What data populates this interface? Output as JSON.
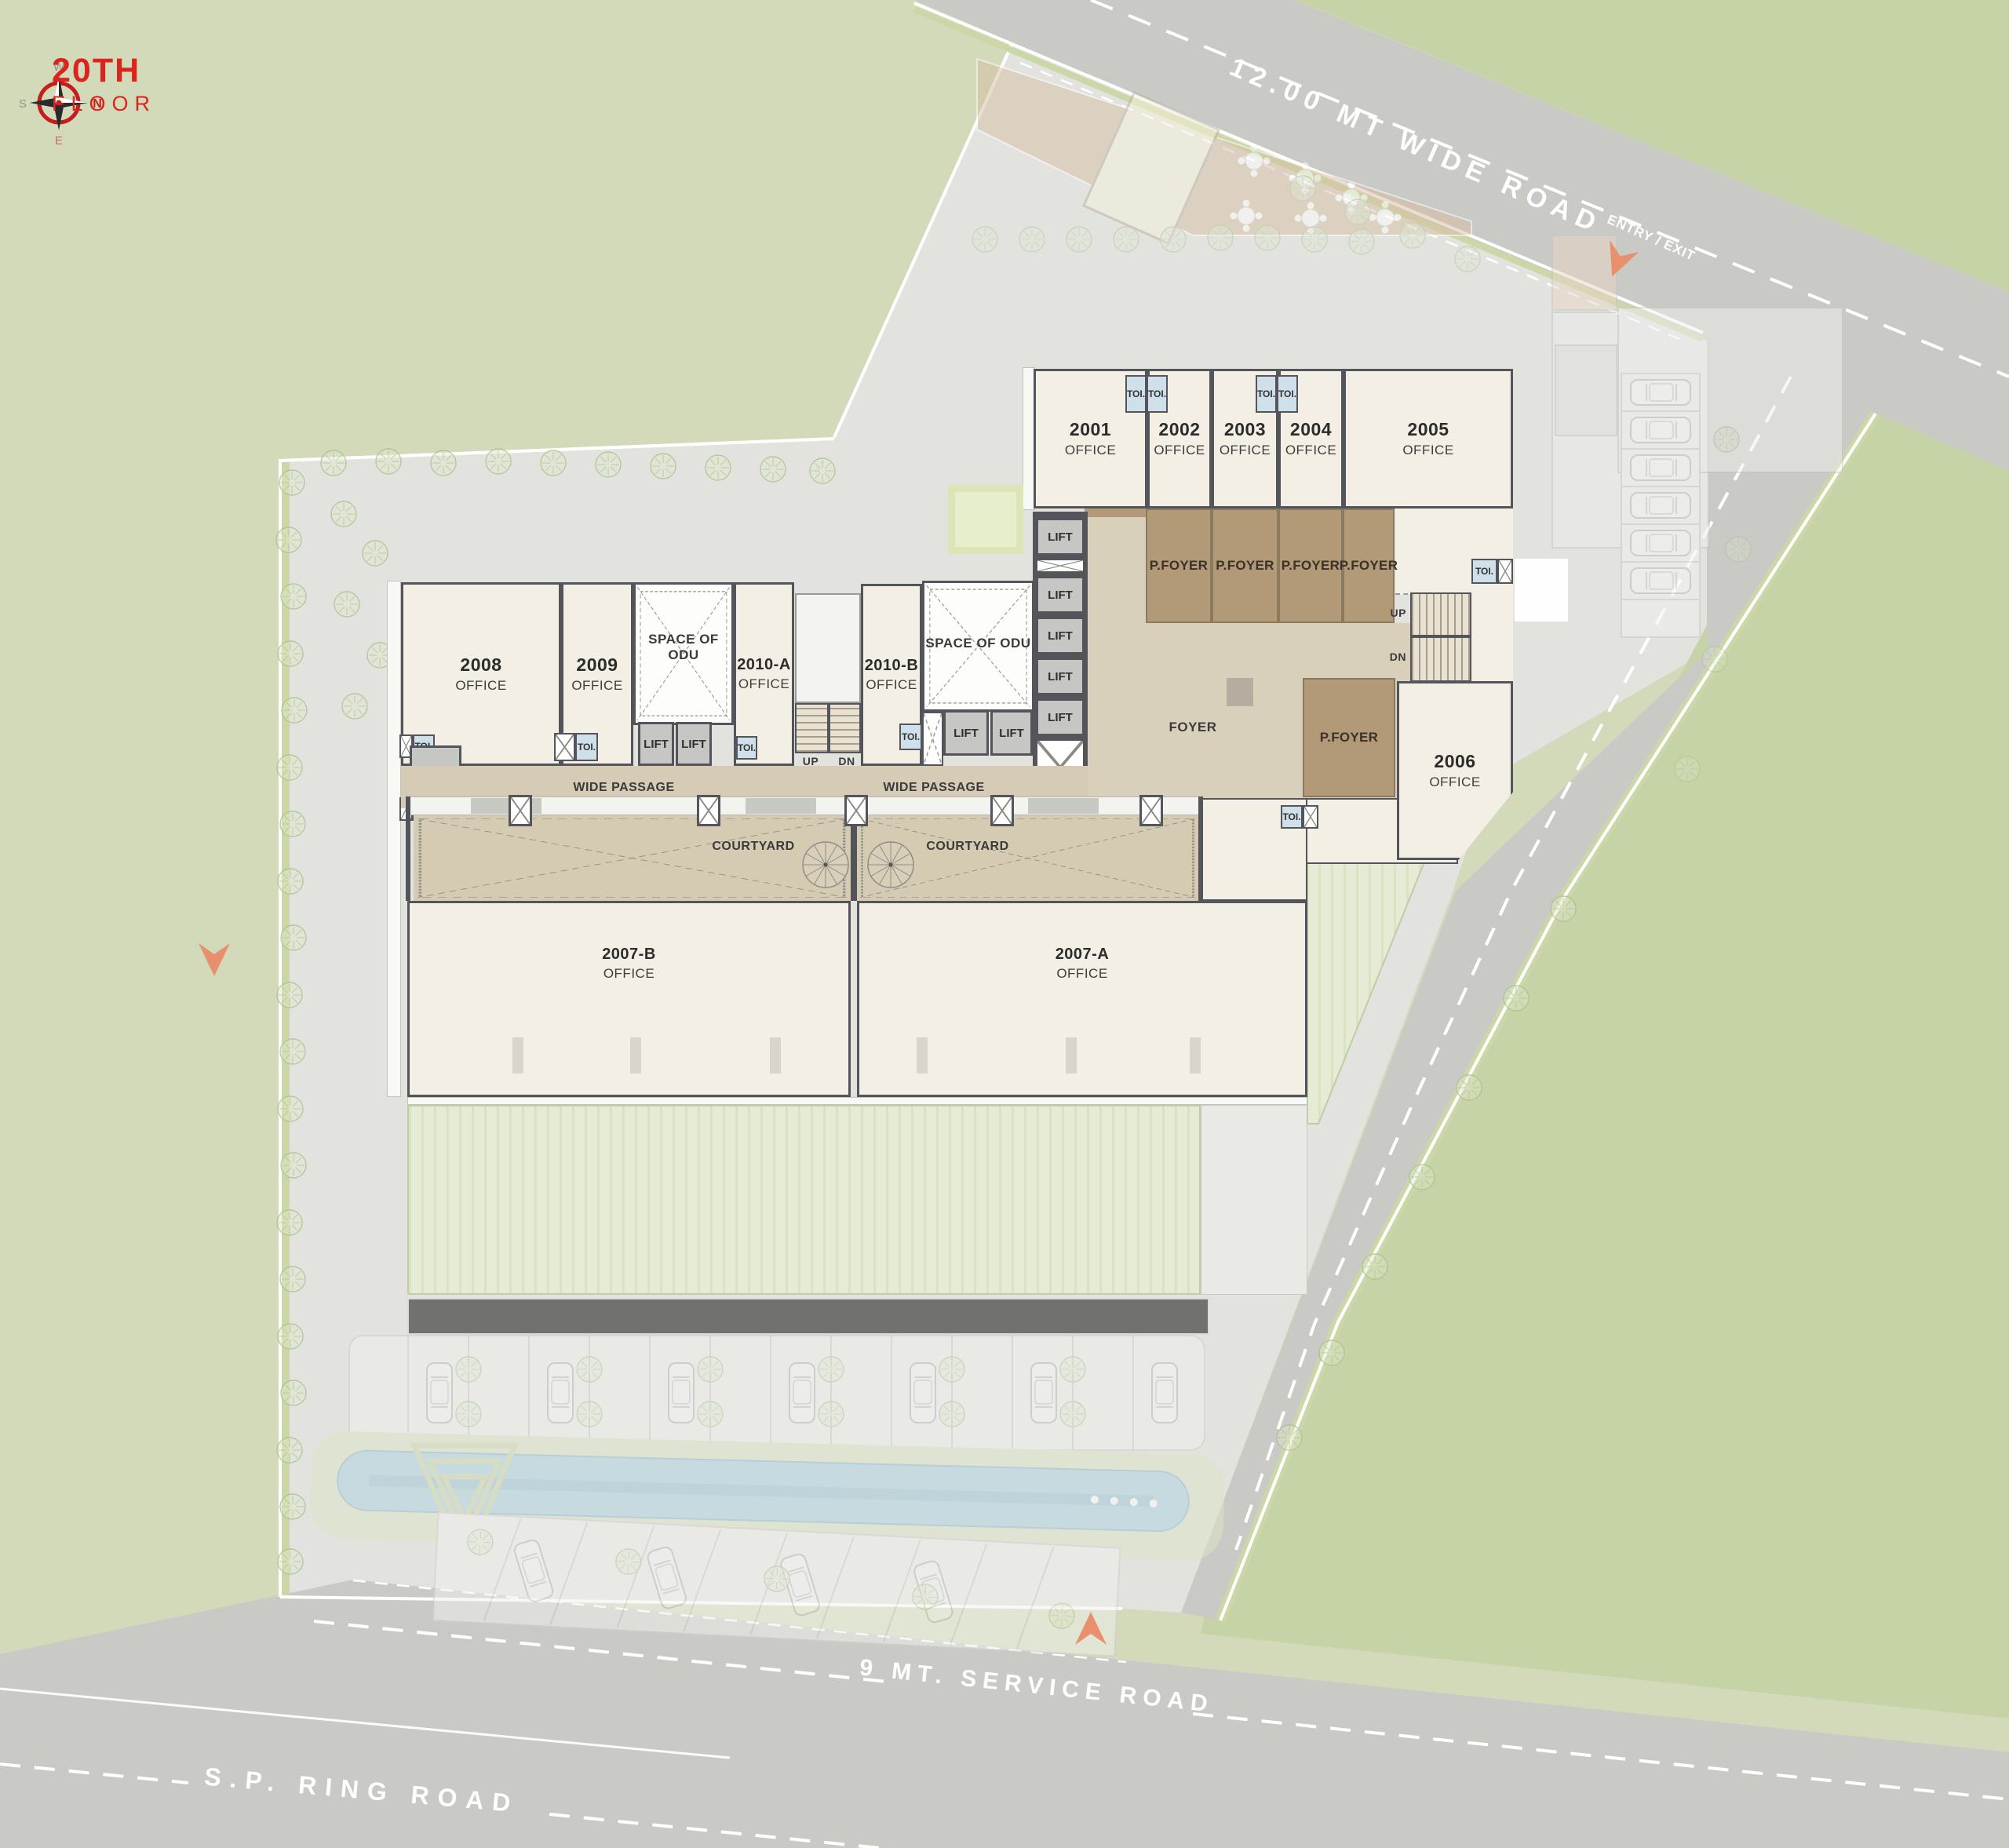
{
  "title": {
    "floor": "20TH",
    "level": "FLOOR"
  },
  "compass": {
    "n": "N",
    "e": "E",
    "s": "S",
    "w": "W"
  },
  "roads": {
    "wide_road": "12.00 MT WIDE ROAD",
    "service_road": "9 MT. SERVICE ROAD",
    "ring_road": "S.P. RING ROAD",
    "entry_exit": "ENTRY / EXIT"
  },
  "plan": {
    "lift": "LIFT",
    "toilet": "TOI.",
    "foyer": "FOYER",
    "p_foyer": "P.FOYER",
    "wide_passage": "WIDE PASSAGE",
    "courtyard": "COURTYARD",
    "space_of_odu": "SPACE OF ODU",
    "up": "UP",
    "dn": "DN"
  },
  "offices": [
    {
      "num": "2001",
      "type": "OFFICE"
    },
    {
      "num": "2002",
      "type": "OFFICE"
    },
    {
      "num": "2003",
      "type": "OFFICE"
    },
    {
      "num": "2004",
      "type": "OFFICE"
    },
    {
      "num": "2005",
      "type": "OFFICE"
    },
    {
      "num": "2006",
      "type": "OFFICE"
    },
    {
      "num": "2008",
      "type": "OFFICE"
    },
    {
      "num": "2009",
      "type": "OFFICE"
    },
    {
      "num": "2010-A",
      "type": "OFFICE"
    },
    {
      "num": "2010-B",
      "type": "OFFICE"
    },
    {
      "num": "2007-B",
      "type": "OFFICE"
    },
    {
      "num": "2007-A",
      "type": "OFFICE"
    }
  ],
  "colors": {
    "accent_red": "#d9251d",
    "entry_orange": "#e8906e",
    "toilet_blue": "#cfe0ea",
    "p_foyer_brown": "#b29a78",
    "foyer_beige": "#d9d0bc",
    "office_cream": "#f3efe4",
    "wall_gray": "#54555a",
    "road_gray": "#c9cac6",
    "grass_green": "#cdd6b2",
    "pool_blue": "#abd0e0"
  }
}
